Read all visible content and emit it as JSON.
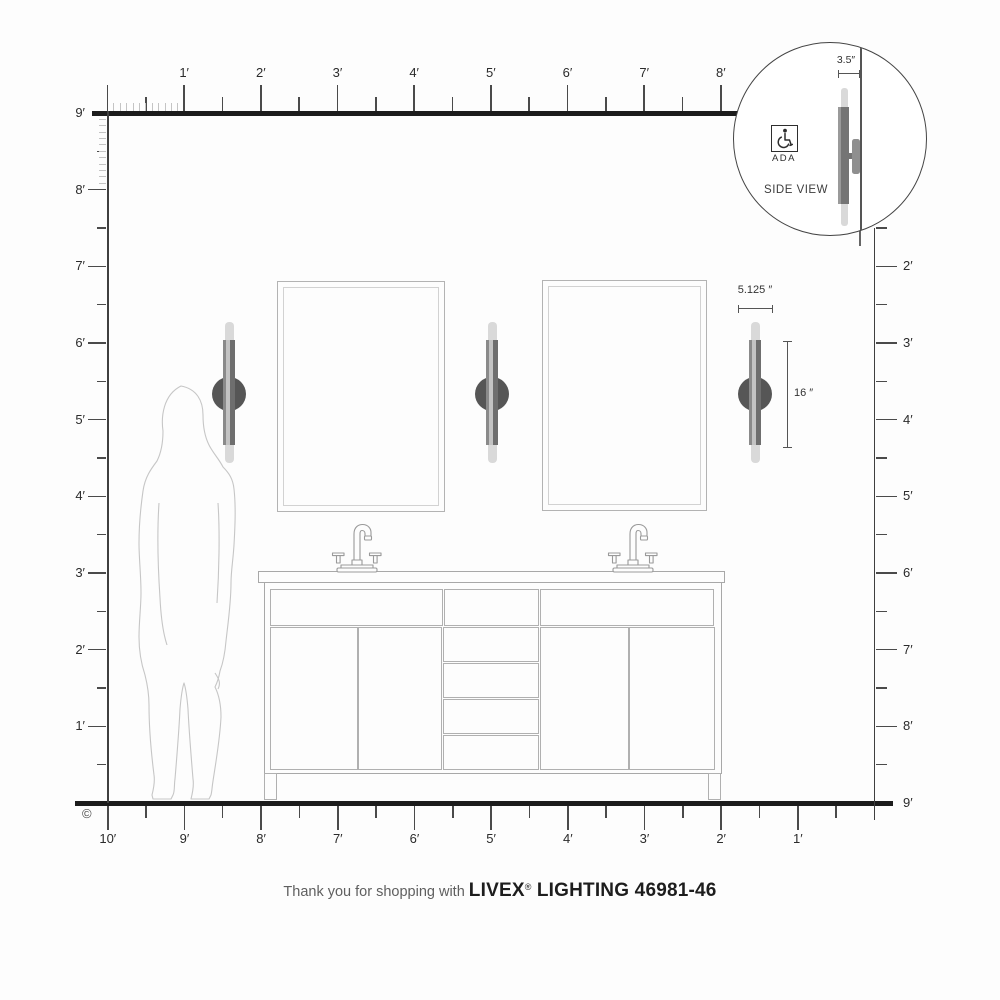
{
  "title": "wall sconce installation dimension diagram",
  "rulers": {
    "top": {
      "labels": [
        "1′",
        "2′",
        "3′",
        "4′",
        "5′",
        "6′",
        "7′",
        "8′"
      ]
    },
    "left": {
      "labels": [
        "9′",
        "8′",
        "7′",
        "6′",
        "5′",
        "4′",
        "3′",
        "2′",
        "1′"
      ]
    },
    "right": {
      "labels": [
        "2′",
        "3′",
        "4′",
        "5′",
        "6′",
        "7′",
        "8′",
        "9′"
      ]
    },
    "bottom": {
      "labels": [
        "10′",
        "9′",
        "8′",
        "7′",
        "6′",
        "5′",
        "4′",
        "3′",
        "2′",
        "1′"
      ]
    }
  },
  "inset": {
    "dimension_label": "3.5″",
    "ada_label": "ADA",
    "view_label": "SIDE VIEW",
    "wheelchair_icon": "wheelchair-icon"
  },
  "fixture_dimensions": {
    "width_label": "5.125 ″",
    "height_label": "16 ″"
  },
  "footer": {
    "thanks_prefix": "Thank you for shopping with",
    "brand": "LIVEX",
    "registered_mark": "®",
    "brand_suffix": " LIGHTING 46981-46"
  },
  "copyright_symbol": "©",
  "colors": {
    "line_dark": "#1c1c1c",
    "line_light": "#c4c4c4",
    "outline_gray": "#b0b0b0",
    "sconce_plate": "#565656",
    "sconce_bar": "#6e6e6e",
    "sconce_bulb": "#d9d9d9",
    "text_dark": "#2b2b2b",
    "text_gray": "#5f5f5f"
  },
  "layout_counts": {
    "wall_sconces": 3,
    "mirrors": 2,
    "faucets": 2,
    "center_drawers": 4
  }
}
